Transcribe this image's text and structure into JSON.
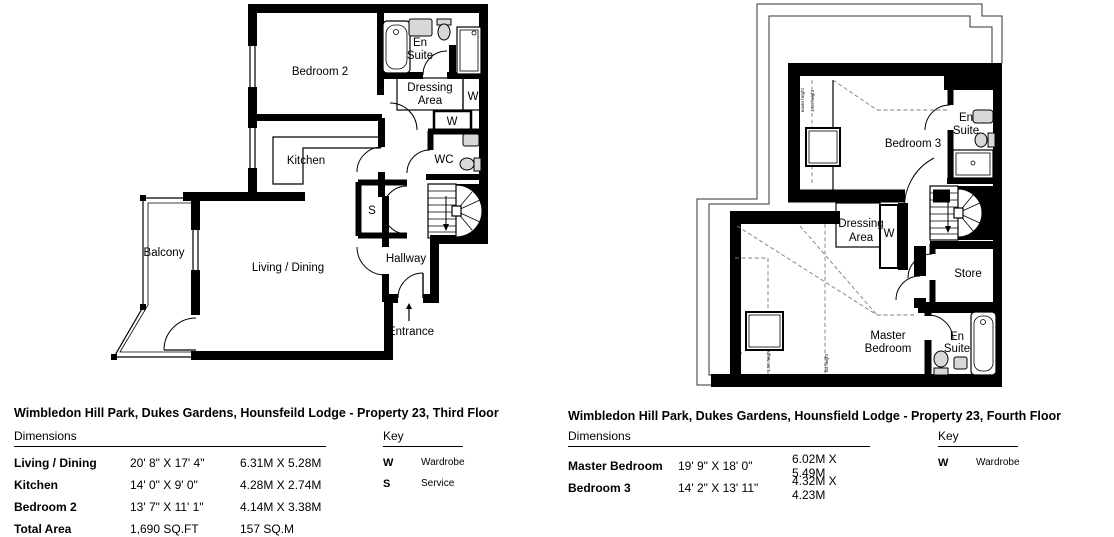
{
  "page": {
    "background": "#ffffff",
    "line_color": "#000000",
    "fixture_fill": "#d8d8d8"
  },
  "plans": [
    {
      "id": "third-floor",
      "title": "Wimbledon Hill Park, Dukes Gardens, Hounsfeild Lodge - Property 23, Third Floor",
      "rooms": {
        "bedroom2": "Bedroom 2",
        "ensuite": [
          "En",
          "Suite"
        ],
        "dressing": [
          "Dressing",
          "Area"
        ],
        "wardrobe1": "W",
        "wardrobe2": "W",
        "wc": "WC",
        "kitchen": "Kitchen",
        "service": "S",
        "hallway": "Hallway",
        "living": "Living / Dining",
        "balcony": "Balcony",
        "entrance": "Entrance"
      },
      "dimensions": {
        "heading": "Dimensions",
        "rows": [
          {
            "name": "Living / Dining",
            "imperial": "20' 8\" X 17' 4\"",
            "metric": "6.31M X 5.28M"
          },
          {
            "name": "Kitchen",
            "imperial": "14' 0\" X 9' 0\"",
            "metric": "4.28M X 2.74M"
          },
          {
            "name": "Bedroom 2",
            "imperial": "13' 7\" X 11' 1\"",
            "metric": "4.14M X 3.38M"
          },
          {
            "name": "Total Area",
            "imperial": "1,690 SQ.FT",
            "metric": "157 SQ.M"
          }
        ]
      },
      "key": {
        "heading": "Key",
        "items": [
          {
            "symbol": "W",
            "label": "Wardrobe"
          },
          {
            "symbol": "S",
            "label": "Service"
          }
        ]
      }
    },
    {
      "id": "fourth-floor",
      "title": "Wimbledon Hill Park, Dukes Gardens, Hounsfield Lodge - Property 23, Fourth Floor",
      "rooms": {
        "bedroom3": "Bedroom 3",
        "ensuite_top": [
          "En",
          "Suite"
        ],
        "dressing": [
          "Dressing",
          "Area"
        ],
        "wardrobe": "W",
        "store": "Store",
        "master": [
          "Master",
          "Bedroom"
        ],
        "ensuite_bottom": [
          "En",
          "Suite"
        ]
      },
      "annotations": {
        "bedroom3": [
          "eaves height",
          "1.5m height"
        ],
        "master": [
          "eaves height",
          "1.5m height",
          "full height"
        ]
      },
      "dimensions": {
        "heading": "Dimensions",
        "rows": [
          {
            "name": "Master Bedroom",
            "imperial": "19' 9\" X 18' 0\"",
            "metric": "6.02M X 5.49M"
          },
          {
            "name": "Bedroom 3",
            "imperial": "14' 2\" X 13' 11\"",
            "metric": "4.32M X 4.23M"
          }
        ]
      },
      "key": {
        "heading": "Key",
        "items": [
          {
            "symbol": "W",
            "label": "Wardrobe"
          }
        ]
      }
    }
  ]
}
